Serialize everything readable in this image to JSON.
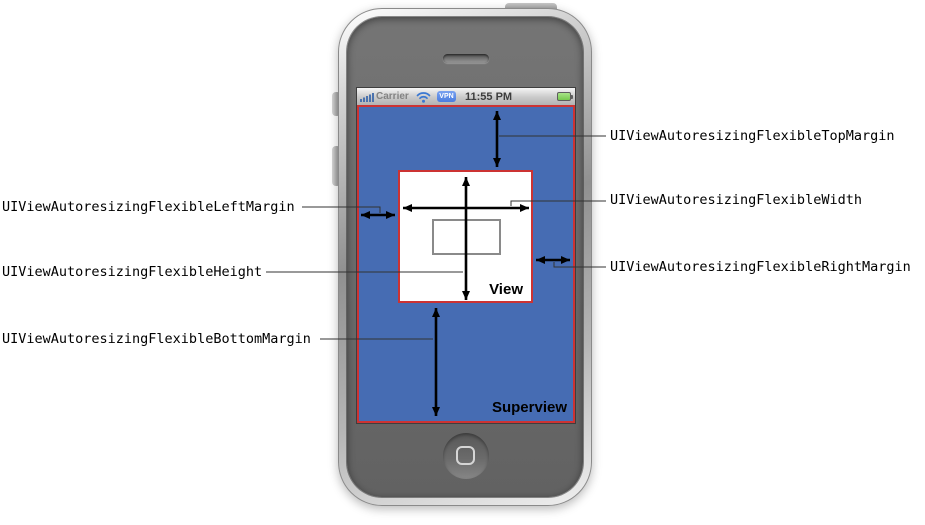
{
  "colors": {
    "superview_blue": "#466cb3",
    "border_red": "#cc3333",
    "vpn_blue": "#4a7ce0",
    "battery_green": "#76c94e",
    "wifi_blue": "#3a78d2",
    "signal_blue": "#4a72ae"
  },
  "phone": {
    "status_bar": {
      "carrier": "Carrier",
      "vpn_badge": "VPN",
      "time": "11:55 PM"
    }
  },
  "diagram": {
    "superview_label": "Superview",
    "view_label": "View",
    "labels": {
      "top_margin": "UIViewAutoresizingFlexibleTopMargin",
      "width": "UIViewAutoresizingFlexibleWidth",
      "right_margin": "UIViewAutoresizingFlexibleRightMargin",
      "left_margin": "UIViewAutoresizingFlexibleLeftMargin",
      "height": "UIViewAutoresizingFlexibleHeight",
      "bottom_margin": "UIViewAutoresizingFlexibleBottomMargin"
    }
  }
}
